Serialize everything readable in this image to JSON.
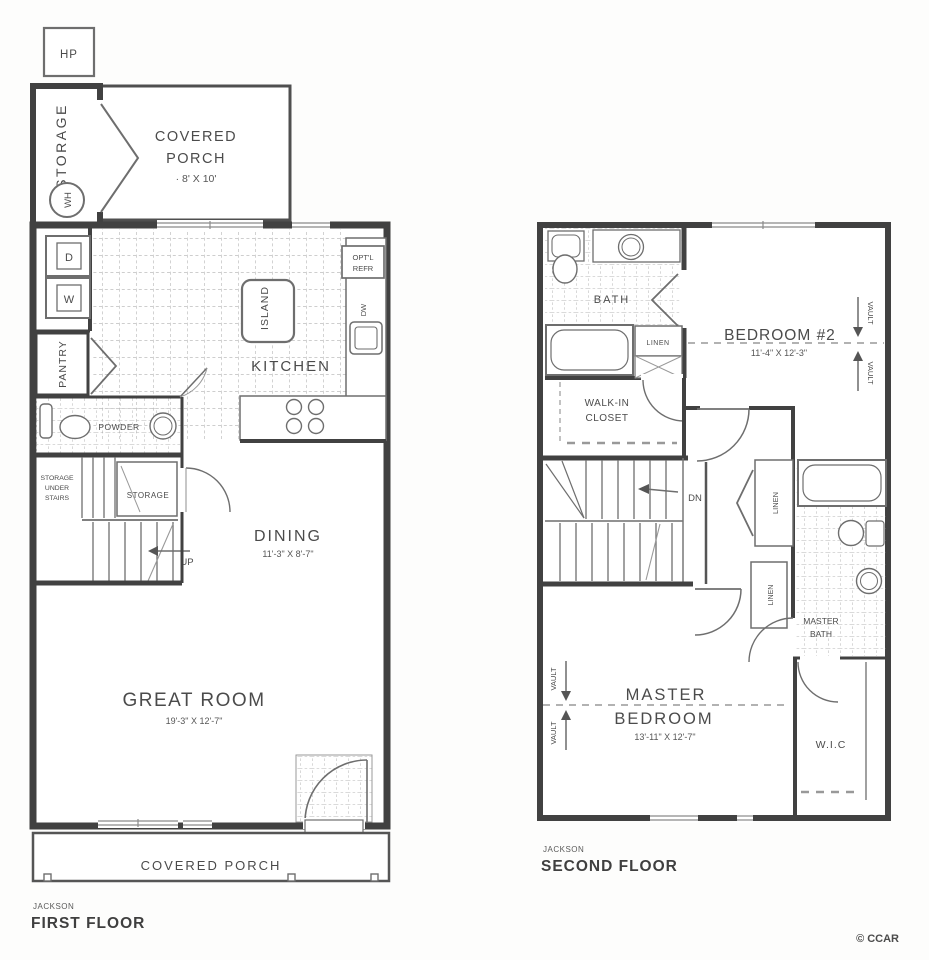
{
  "meta": {
    "copyright": "© CCAR"
  },
  "first_floor": {
    "plan_name": "JACKSON",
    "floor_label": "FIRST FLOOR",
    "hp": "HP",
    "storage_vertical": "STORAGE",
    "water_heater": "WH",
    "porch_top": {
      "line1": "COVERED",
      "line2": "PORCH",
      "dims": "· 8' X 10'"
    },
    "dryer": "D",
    "washer": "W",
    "pantry": "PANTRY",
    "powder": "POWDER",
    "island": "ISLAND",
    "kitchen": "KITCHEN",
    "opt_refr_line1": "OPT'L",
    "opt_refr_line2": "REFR",
    "dishwasher": "DW",
    "storage_under_stairs": {
      "line1": "STORAGE",
      "line2": "UNDER",
      "line3": "STAIRS"
    },
    "stair_storage": "STORAGE",
    "up": "UP",
    "dining": {
      "name": "DINING",
      "dims": "11'-3\" X 8'-7\""
    },
    "great_room": {
      "name": "GREAT ROOM",
      "dims": "19'-3\" X 12'-7\""
    },
    "porch_bottom": "COVERED PORCH"
  },
  "second_floor": {
    "plan_name": "JACKSON",
    "floor_label": "SECOND FLOOR",
    "bath": "BATH",
    "linen": "LINEN",
    "bedroom2": {
      "name": "BEDROOM #2",
      "dims": "11'-4\" X 12'-3\""
    },
    "vault": "VAULT",
    "walk_in_closet": {
      "line1": "WALK-IN",
      "line2": "CLOSET"
    },
    "down": "DN",
    "master_bath": {
      "line1": "MASTER",
      "line2": "BATH"
    },
    "master_bedroom": {
      "line1": "MASTER",
      "line2": "BEDROOM",
      "dims": "13'-11\" X 12'-7\""
    },
    "wic": "W.I.C"
  }
}
